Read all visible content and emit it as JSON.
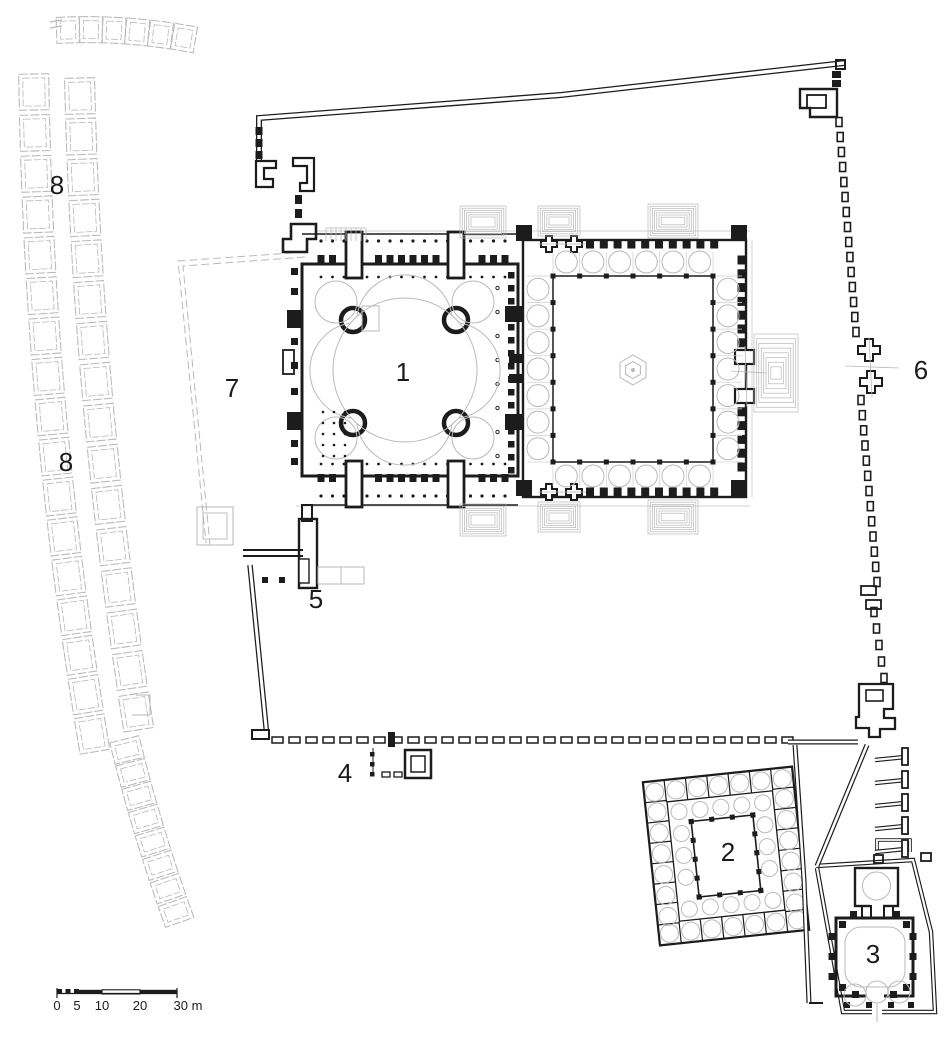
{
  "plan": {
    "labels": [
      {
        "id": "1",
        "text": "1"
      },
      {
        "id": "2",
        "text": "2"
      },
      {
        "id": "3",
        "text": "3"
      },
      {
        "id": "4",
        "text": "4"
      },
      {
        "id": "5",
        "text": "5"
      },
      {
        "id": "6",
        "text": "6"
      },
      {
        "id": "7",
        "text": "7"
      },
      {
        "id": "8-upper",
        "text": "8"
      },
      {
        "id": "8-lower",
        "text": "8"
      }
    ],
    "scale_bar": {
      "ticks": [
        "0",
        "5",
        "10",
        "20",
        "30 m"
      ]
    }
  },
  "colors": {
    "ink": "#1c1c1c",
    "light": "#b9b9b9",
    "faint": "#d2d2d2",
    "paper": "#ffffff"
  }
}
